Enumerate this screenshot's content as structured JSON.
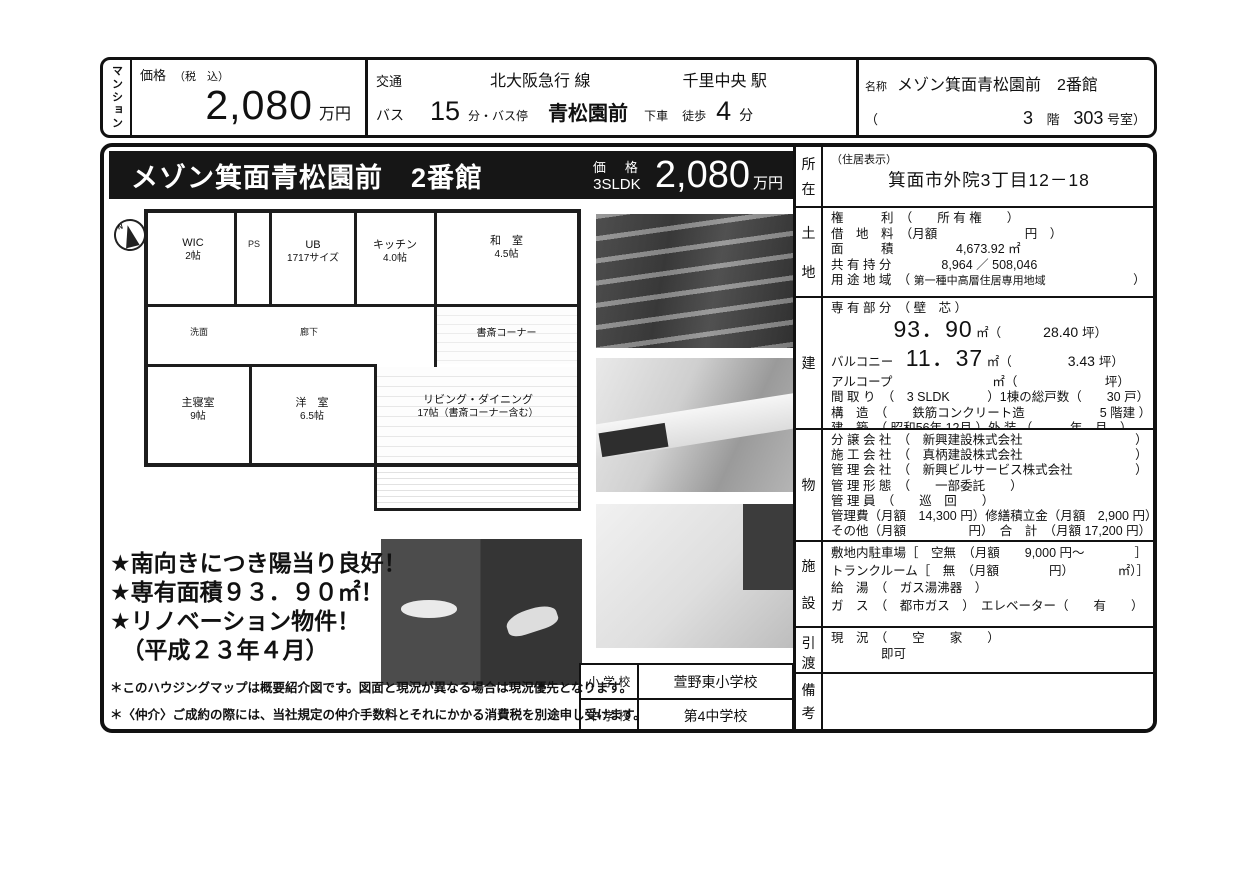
{
  "header": {
    "category_vertical": "マンション",
    "price": {
      "label": "価格",
      "tax_note": "（税　込）",
      "value": "2,080",
      "unit": "万円"
    },
    "transport": {
      "label": "交通",
      "line": "北大阪急行 線",
      "station": "千里中央 駅",
      "bus_label": "バス",
      "bus_minutes": "15",
      "bus_stop_label": "分・バス停",
      "bus_stop": "青松園前",
      "alight": "下車",
      "walk_label": "徒歩",
      "walk_minutes": "4",
      "walk_unit": "分"
    },
    "name": {
      "label": "名称",
      "value": "メゾン箕面青松園前　2番館",
      "paren_open": "（",
      "floor": "3",
      "floor_unit": "階",
      "room": "303",
      "room_unit": "号室）"
    }
  },
  "title_bar": {
    "title": "メゾン箕面青松園前　2番館",
    "price_label": "価　格",
    "layout": "3SLDK",
    "price_value": "2,080",
    "price_unit": "万円"
  },
  "floor_plan": {
    "compass_letter": "N",
    "rooms": {
      "wic": {
        "name": "WIC",
        "size": "2帖"
      },
      "ps": {
        "name": "PS"
      },
      "bath": {
        "name": "UB",
        "size": "1717サイズ"
      },
      "kitchen": {
        "name": "キッチン",
        "size": "4.0帖"
      },
      "washroom": {
        "name": "洗面"
      },
      "corridor": {
        "name": "廊下"
      },
      "japanese_room": {
        "name": "和　室",
        "size": "4.5帖"
      },
      "study_corner": {
        "name": "書斎コーナー"
      },
      "master_bedroom": {
        "name": "主寝室",
        "size": "9帖"
      },
      "western_room": {
        "name": "洋　室",
        "size": "6.5帖"
      },
      "living_dining": {
        "name": "リビング・ダイニング",
        "size": "17帖（書斎コーナー含む）"
      }
    }
  },
  "features": [
    "★南向きにつき陽当り良好！",
    "★専有面積９３．９０㎡！",
    "★リノベーション物件！",
    "　（平成２３年４月）"
  ],
  "schools": {
    "rows": [
      {
        "label": "小 学 校",
        "value": "萱野東小学校"
      },
      {
        "label": "中 学 校",
        "value": "第4中学校"
      }
    ]
  },
  "disclaimers": [
    "＊このハウジングマップは概要紹介図です。図面と現況が異なる場合は現況優先となります。",
    "＊〈仲介〉ご成約の際には、当社規定の仲介手数料とそれにかかる消費税を別途申し受けます。"
  ],
  "details": {
    "sections": [
      {
        "label": [
          "所",
          "在"
        ],
        "rows": [
          {
            "segs": [
              {
                "t": "（住居表示）",
                "c": "sm"
              }
            ]
          },
          {
            "align": "center",
            "segs": [
              {
                "t": "箕面市外院3丁目12－18",
                "c": "addr"
              }
            ]
          }
        ]
      },
      {
        "label": [
          "土",
          "地"
        ],
        "rows": [
          {
            "segs": [
              {
                "t": "権　　　利　（　　所 有 権　　）"
              }
            ]
          },
          {
            "segs": [
              {
                "t": "借　地　料　（月額　　　　　　　円　）"
              }
            ]
          },
          {
            "segs": [
              {
                "t": "面　　　積　　　　　4,673.92 ㎡"
              }
            ]
          },
          {
            "segs": [
              {
                "t": "共 有 持 分　　　　8,964 ／ 508,046"
              }
            ]
          },
          {
            "segs": [
              {
                "t": "用 途 地 域　（ "
              },
              {
                "t": "第一種中高層住居専用地域",
                "c": "sm"
              },
              {
                "t": "　　　　　　　）"
              }
            ]
          }
        ]
      },
      {
        "label": [
          "建"
        ],
        "rows": [
          {
            "segs": [
              {
                "t": "専 有 部 分　（ 壁　芯 ）"
              }
            ]
          },
          {
            "big": true,
            "segs": [
              {
                "t": "　　　　　"
              },
              {
                "t": "93．90",
                "c": "big"
              },
              {
                "t": " ㎡（"
              },
              {
                "t": "　　　28.40 ",
                "c": "md"
              },
              {
                "t": "坪）"
              }
            ]
          },
          {
            "big": true,
            "segs": [
              {
                "t": "バルコニー　"
              },
              {
                "t": "11．37",
                "c": "big"
              },
              {
                "t": " ㎡（"
              },
              {
                "t": "　　　　3.43 ",
                "c": "md"
              },
              {
                "t": "坪）"
              }
            ]
          },
          {
            "segs": [
              {
                "t": "アルコープ　　　　　　　　㎡（　　　　　　　坪）"
              }
            ]
          },
          {
            "segs": [
              {
                "t": "間 取 り　（　3 SLDK　　　）1棟の総戸数（　　30 戸）"
              }
            ]
          },
          {
            "segs": [
              {
                "t": "構　造　（　　鉄筋コンクリート造　　　　　　5 階建 ）"
              }
            ]
          },
          {
            "segs": [
              {
                "t": "建　築　（ 昭和56年 12月 ）外 装 （　　　年　月　）"
              }
            ]
          }
        ]
      },
      {
        "label": [
          "物"
        ],
        "rows": [
          {
            "segs": [
              {
                "t": "分 譲 会 社　（　新興建設株式会社　　　　　　　　　）"
              }
            ]
          },
          {
            "segs": [
              {
                "t": "施 工 会 社　（　真柄建設株式会社　　　　　　　　　）"
              }
            ]
          },
          {
            "segs": [
              {
                "t": "管 理 会 社　（　新興ビルサービス株式会社　　　　　）"
              }
            ]
          },
          {
            "segs": [
              {
                "t": "管 理 形 態　（　　一部委託　　）"
              }
            ]
          },
          {
            "segs": [
              {
                "t": "管 理 員　（　　巡　回　　）"
              }
            ]
          },
          {
            "segs": [
              {
                "t": "管理費（月額　14,300 円）修繕積立金（月額　2,900 円）"
              }
            ]
          },
          {
            "segs": [
              {
                "t": "その他（月額　　　　　円）　合　計　（月額 17,200 円）"
              }
            ]
          }
        ]
      },
      {
        "label": [
          "施",
          "設"
        ],
        "rows": [
          {
            "segs": [
              {
                "t": "敷地内駐車場［　空無　（月額　　9,000 円～　　　　］"
              }
            ]
          },
          {
            "segs": [
              {
                "t": "トランクルーム［　無　（月額　　　　円）　　　　㎡）］"
              }
            ]
          },
          {
            "segs": [
              {
                "t": "給　湯　（　ガス湯沸器　）"
              }
            ]
          },
          {
            "segs": [
              {
                "t": "ガ　ス　（　都市ガス　）　エレベーター（　　有　　）"
              }
            ]
          }
        ]
      },
      {
        "label": [
          "引",
          "渡"
        ],
        "rows": [
          {
            "segs": [
              {
                "t": "現　況　（　　空　　家　　）"
              }
            ]
          },
          {
            "segs": [
              {
                "t": "　　　　即可"
              }
            ]
          }
        ]
      },
      {
        "label": [
          "備",
          "考"
        ],
        "rows": []
      }
    ]
  }
}
